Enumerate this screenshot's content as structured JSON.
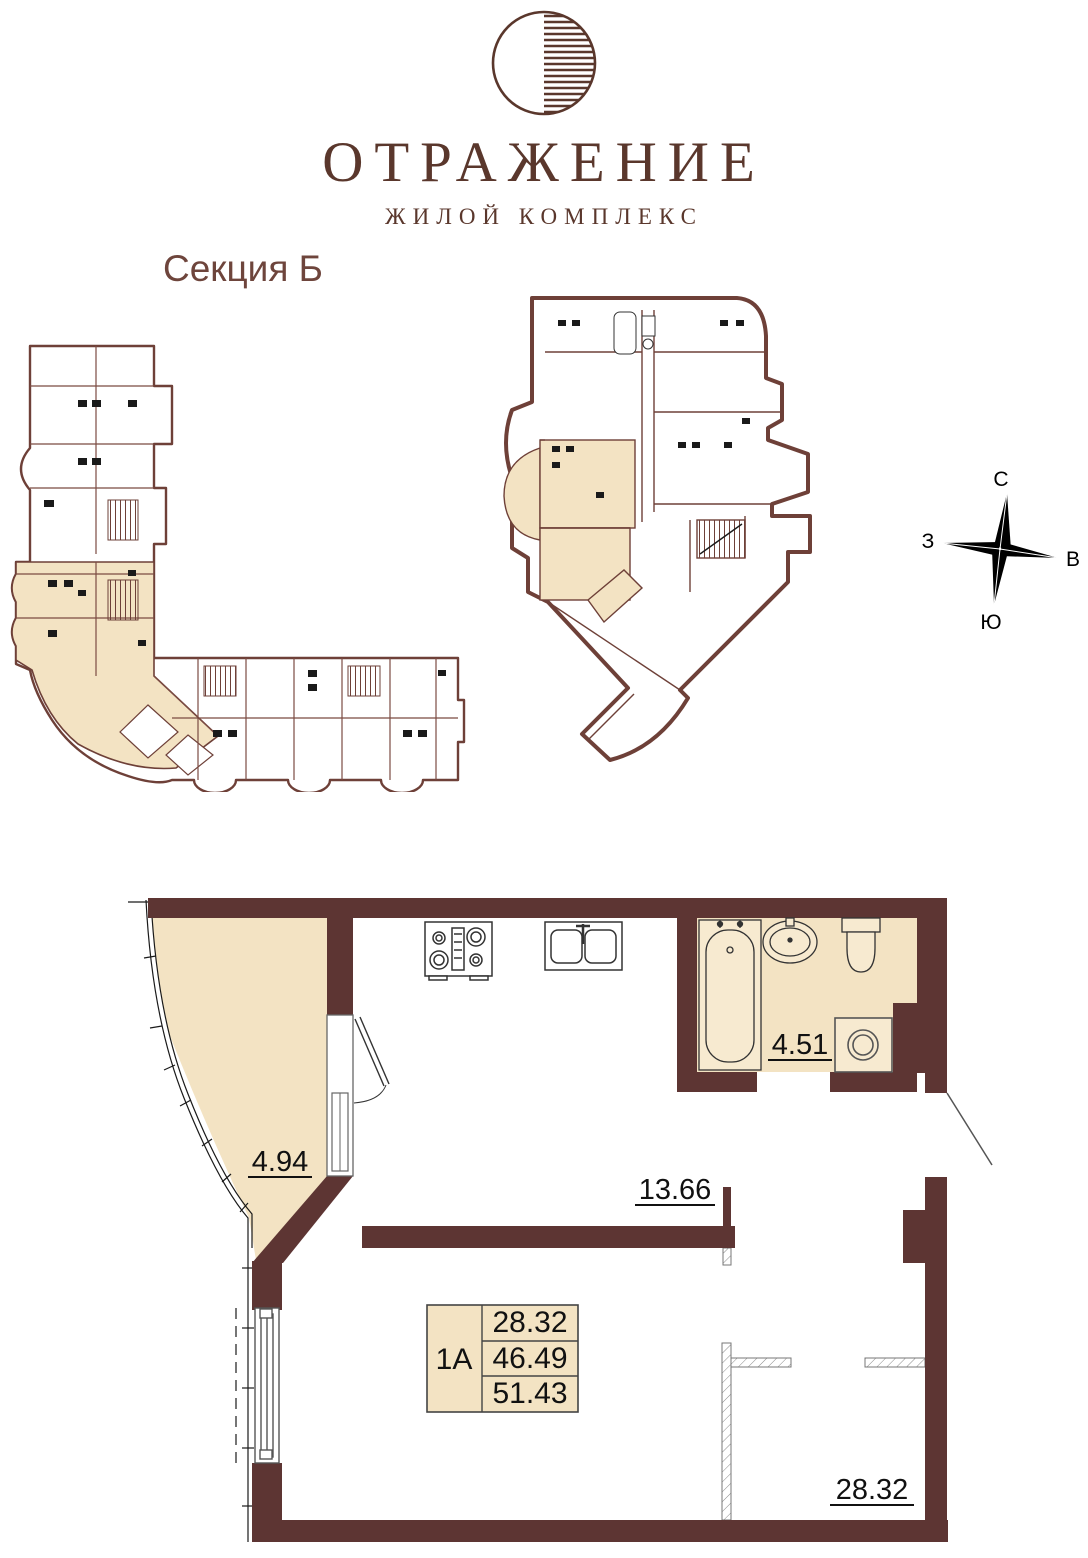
{
  "logo": {
    "title": "ОТРАЖЕНИЕ",
    "subtitle": "ЖИЛОЙ КОМПЛЕКС",
    "brand_color": "#5a372c"
  },
  "section_label": "Секция Б",
  "compass": {
    "north": "С",
    "south": "Ю",
    "west": "З",
    "east": "В"
  },
  "apartment_plan": {
    "rooms": {
      "balcony": {
        "area": "4.94"
      },
      "bathroom": {
        "area": "4.51"
      },
      "kitchen": {
        "area": "13.66"
      },
      "living_room": {
        "area": "28.32"
      }
    },
    "info_table": {
      "unit": "1А",
      "rows": [
        "28.32",
        "46.49",
        "51.43"
      ]
    }
  },
  "colors": {
    "wall_dark": "#5d3533",
    "wall_overview": "#6e4038",
    "room_highlight": "#f3e3c3",
    "label_text": "#111111"
  }
}
